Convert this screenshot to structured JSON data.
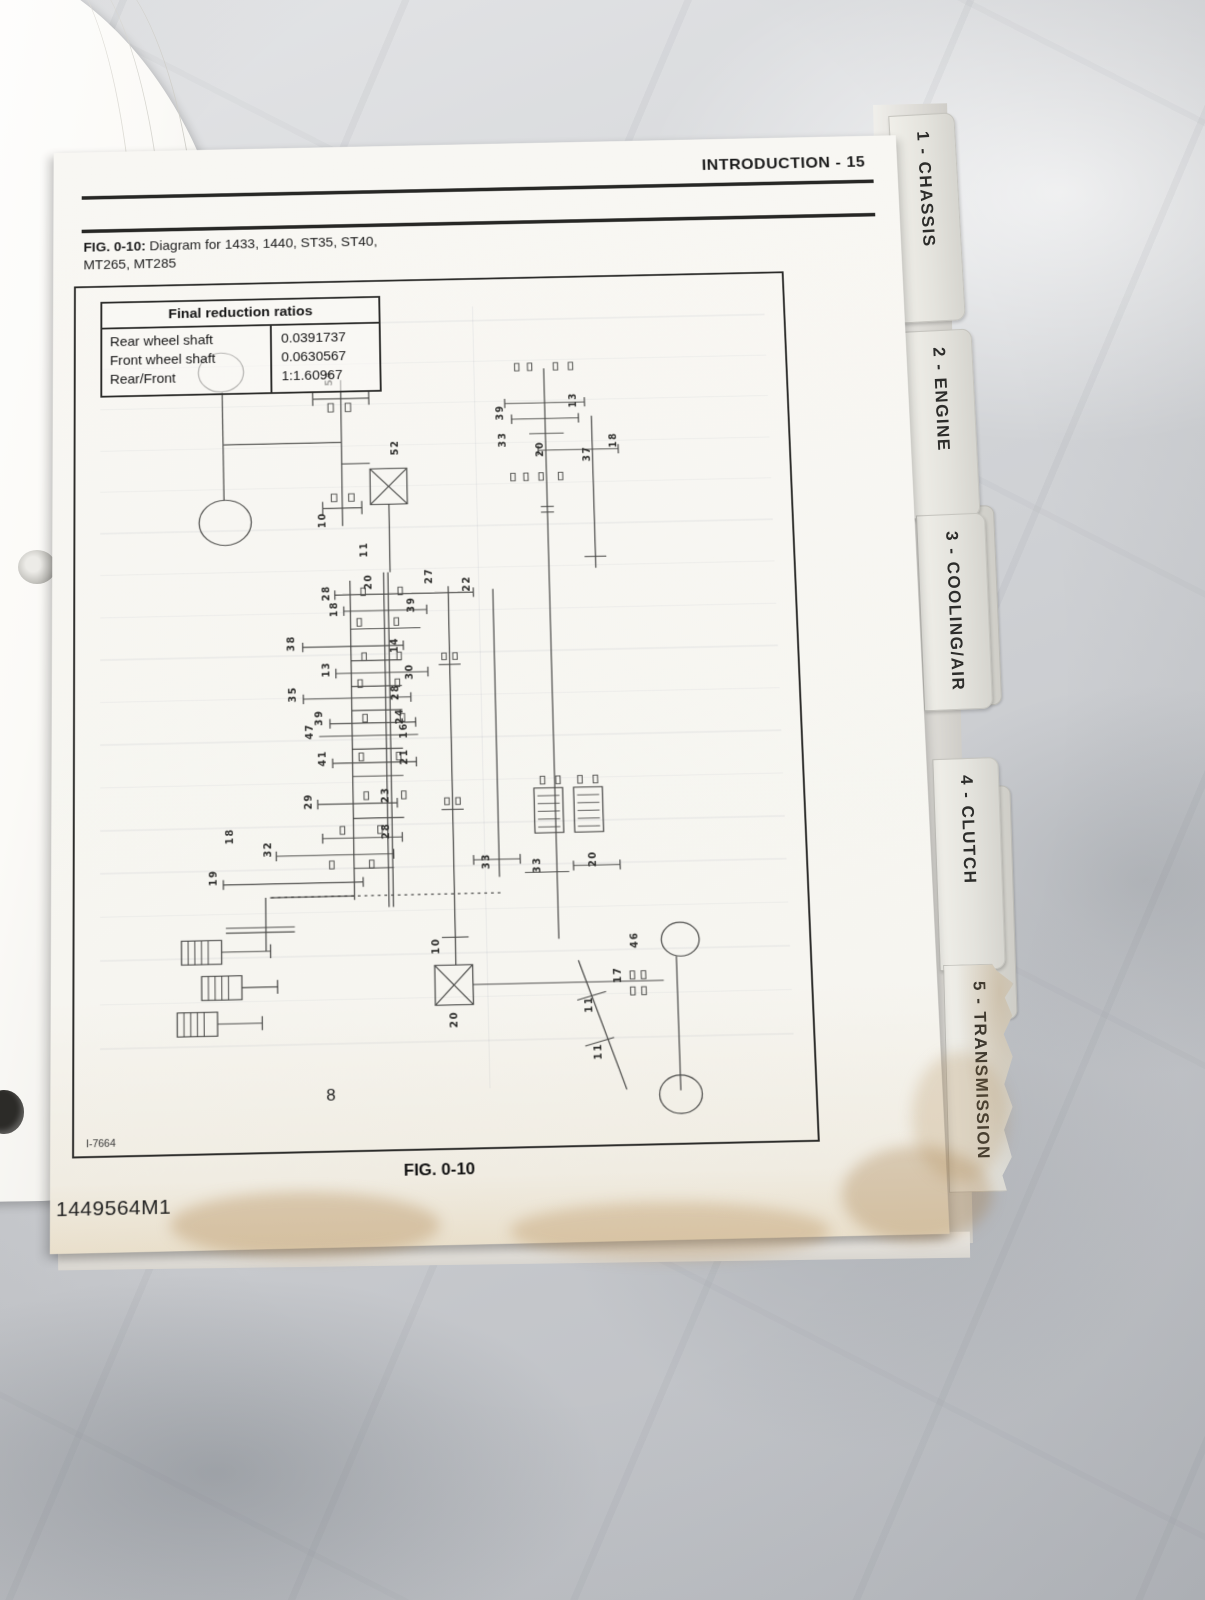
{
  "page": {
    "header": "INTRODUCTION - 15",
    "figure_caption_bold": "FIG. 0-10:",
    "figure_caption_rest": " Diagram for 1433, 1440, ST35, ST40,",
    "figure_caption_line2": "MT265, MT285",
    "figure_label": "FIG. 0-10",
    "diagram_page_number": "8",
    "diagram_ref": "I-7664",
    "part_number": "1449564M1"
  },
  "table": {
    "title": "Final reduction ratios",
    "rows": [
      {
        "label": "Rear wheel shaft",
        "value": "0.0391737"
      },
      {
        "label": "Front wheel shaft",
        "value": "0.0630567"
      },
      {
        "label": "Rear/Front",
        "value": "1:1.60967"
      }
    ]
  },
  "tabs": [
    {
      "label": "1 - CHASSIS"
    },
    {
      "label": "2 - ENGINE"
    },
    {
      "label": "3 - COOLING/AIR"
    },
    {
      "label": "4 - CLUTCH"
    },
    {
      "label": "5 - TRANSMISSION"
    }
  ],
  "hidden_tabs": [
    {
      "label": "STEERING"
    },
    {
      "label": "HYDRAULICS"
    }
  ],
  "diagram": {
    "gear_labels": [
      {
        "t": "54",
        "x": 238,
        "y": 112
      },
      {
        "t": "52",
        "x": 298,
        "y": 188
      },
      {
        "t": "10",
        "x": 230,
        "y": 264
      },
      {
        "t": "11",
        "x": 268,
        "y": 296
      },
      {
        "t": "28",
        "x": 233,
        "y": 341
      },
      {
        "t": "20",
        "x": 272,
        "y": 330
      },
      {
        "t": "27",
        "x": 327,
        "y": 325
      },
      {
        "t": "22",
        "x": 362,
        "y": 334
      },
      {
        "t": "18",
        "x": 240,
        "y": 358
      },
      {
        "t": "39",
        "x": 311,
        "y": 355
      },
      {
        "t": "38",
        "x": 200,
        "y": 393
      },
      {
        "t": "14",
        "x": 295,
        "y": 397
      },
      {
        "t": "13",
        "x": 232,
        "y": 421
      },
      {
        "t": "30",
        "x": 308,
        "y": 425
      },
      {
        "t": "35",
        "x": 201,
        "y": 446
      },
      {
        "t": "28",
        "x": 295,
        "y": 446
      },
      {
        "t": "39",
        "x": 225,
        "y": 471
      },
      {
        "t": "47",
        "x": 216,
        "y": 485
      },
      {
        "t": "24",
        "x": 298,
        "y": 471
      },
      {
        "t": "16",
        "x": 302,
        "y": 486
      },
      {
        "t": "41",
        "x": 228,
        "y": 513
      },
      {
        "t": "21",
        "x": 302,
        "y": 513
      },
      {
        "t": "29",
        "x": 214,
        "y": 557
      },
      {
        "t": "23",
        "x": 284,
        "y": 552
      },
      {
        "t": "28",
        "x": 284,
        "y": 589
      },
      {
        "t": "18",
        "x": 143,
        "y": 591
      },
      {
        "t": "32",
        "x": 177,
        "y": 605
      },
      {
        "t": "19",
        "x": 128,
        "y": 633
      },
      {
        "t": "39",
        "x": 396,
        "y": 153
      },
      {
        "t": "33",
        "x": 398,
        "y": 182
      },
      {
        "t": "20",
        "x": 432,
        "y": 193
      },
      {
        "t": "13",
        "x": 464,
        "y": 141
      },
      {
        "t": "37",
        "x": 476,
        "y": 199
      },
      {
        "t": "18",
        "x": 500,
        "y": 185
      },
      {
        "t": "33",
        "x": 374,
        "y": 622
      },
      {
        "t": "33",
        "x": 420,
        "y": 627
      },
      {
        "t": "20",
        "x": 470,
        "y": 622
      },
      {
        "t": "10",
        "x": 327,
        "y": 707
      },
      {
        "t": "20",
        "x": 342,
        "y": 781
      },
      {
        "t": "46",
        "x": 506,
        "y": 705
      },
      {
        "t": "17",
        "x": 490,
        "y": 740
      },
      {
        "t": "11",
        "x": 463,
        "y": 769
      },
      {
        "t": "11",
        "x": 470,
        "y": 816
      }
    ]
  }
}
